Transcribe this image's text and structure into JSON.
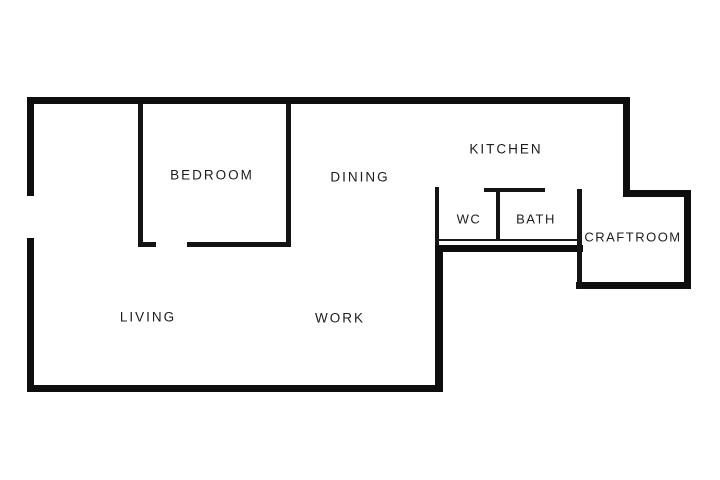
{
  "diagram": {
    "type": "floor-plan",
    "background_color": "#ffffff",
    "wall_color": "#0e0e0e",
    "label_color": "#1d1d1d"
  },
  "rooms": [
    {
      "label": "BEDROOM",
      "center_x": 212,
      "center_y": 175
    },
    {
      "label": "DINING",
      "center_x": 360,
      "center_y": 177
    },
    {
      "label": "KITCHEN",
      "center_x": 506,
      "center_y": 149
    },
    {
      "label": "WC",
      "center_x": 469,
      "center_y": 219
    },
    {
      "label": "BATH",
      "center_x": 536,
      "center_y": 219
    },
    {
      "label": "CRAFTROOM",
      "center_x": 633,
      "center_y": 237
    },
    {
      "label": "LIVING",
      "center_x": 148,
      "center_y": 317
    },
    {
      "label": "WORK",
      "center_x": 340,
      "center_y": 318
    }
  ]
}
